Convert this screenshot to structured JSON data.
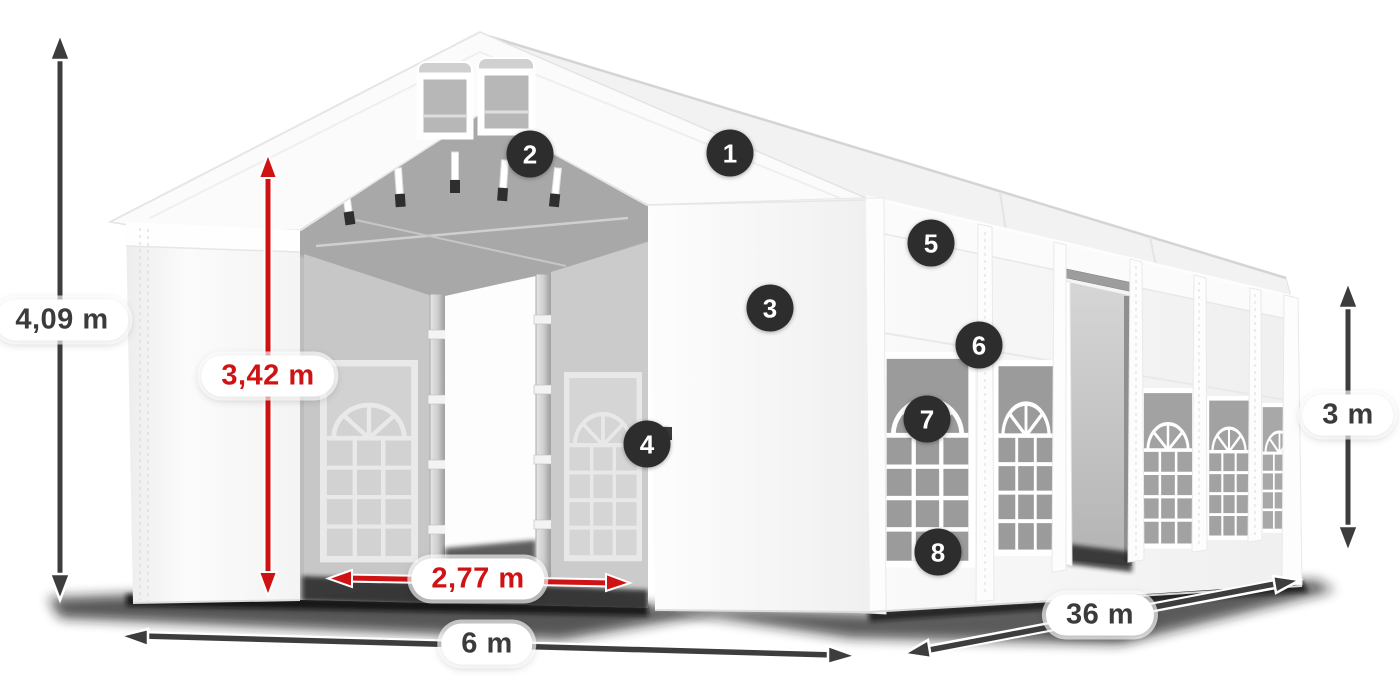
{
  "dimensions": {
    "total_height": "4,09 m",
    "entrance_height": "3,42 m",
    "entrance_width": "2,77 m",
    "front_width": "6 m",
    "side_length": "36 m",
    "side_height": "3 m"
  },
  "hotspots": [
    "1",
    "2",
    "3",
    "4",
    "5",
    "6",
    "7",
    "8"
  ],
  "colors": {
    "dimension_red": "#cf1315",
    "dimension_dark": "#3d3d3d",
    "hotspot_background": "#2d2d2d",
    "tent_white": "#fafafa",
    "interior_gray": "#c5c5c5"
  }
}
